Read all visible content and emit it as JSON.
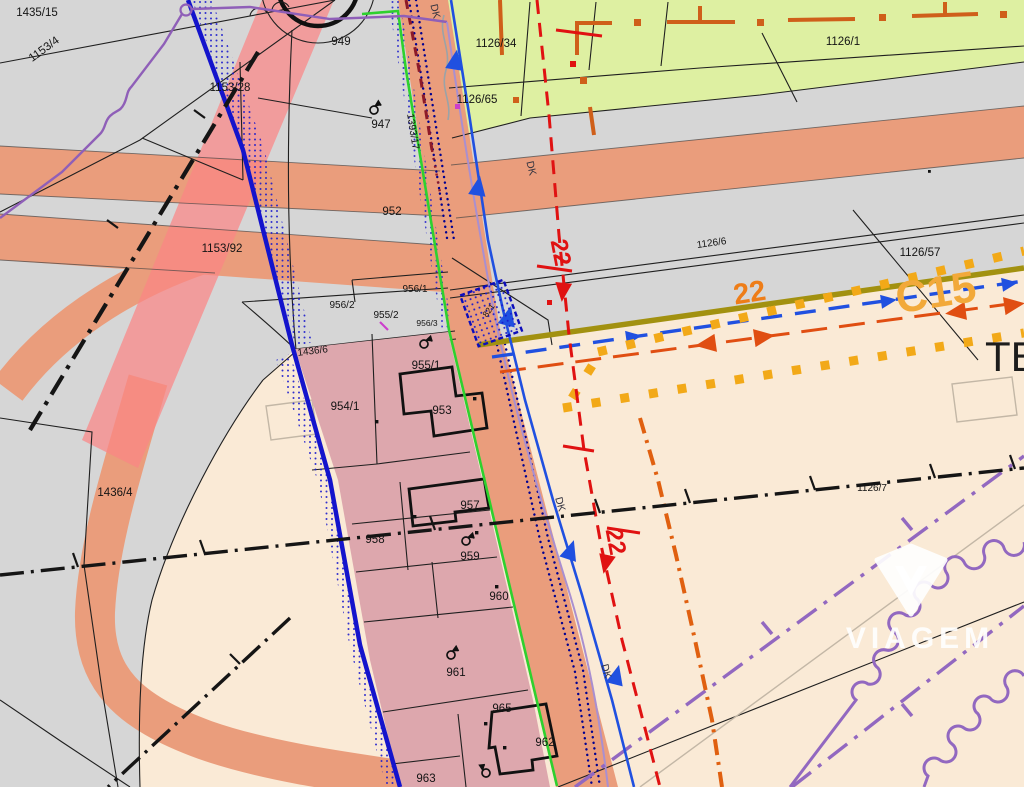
{
  "labels": {
    "p1435_15": "1435/15",
    "p1153_4": "1153/4",
    "p1153_28": "1153/28",
    "p949": "949",
    "p947": "947",
    "p1393_17": "1393/17",
    "p952": "952",
    "p1153_92": "1153/92",
    "p956_1": "956/1",
    "p956_2": "956/2",
    "p955_2": "955/2",
    "p956_3": "956/3",
    "p821": "821",
    "p1436_6": "1436/6",
    "p954_1": "954/1",
    "p955_1": "955/1",
    "p953": "953",
    "p1436_4": "1436/4",
    "p957": "957",
    "p958": "958",
    "p959": "959",
    "p960": "960",
    "p961": "961",
    "p965": "965",
    "p962": "962",
    "p963": "963",
    "p1126_34": "1126/34",
    "p1126_65": "1126/65",
    "p1126_1": "1126/1",
    "p1126_6": "1126/6",
    "p1126_57": "1126/57",
    "p1126_7": "1126/7"
  },
  "annotations": {
    "te": "TE",
    "c15": "C15",
    "orange_22": "22",
    "red_22_upper": "22",
    "red_22_lower": "22",
    "dk": "DK"
  },
  "watermark": {
    "brand": "VIAGEM"
  },
  "colors": {
    "base_gray": "#d6d6d6",
    "beige": "#faead6",
    "green_area": "#def0a2",
    "road": "#ea9d7c",
    "pink_band": "#fb8585",
    "zone_pink": "#dda7ad",
    "boundary_blue": "#1414cc",
    "green_line": "#2ed12e",
    "olive": "#a29110",
    "orange_marker": "#f2a918",
    "arrow_blue": "#2050e0",
    "red_line": "#e01212",
    "orange_red": "#e04e12",
    "purple": "#8f5fb8",
    "maroon": "#8e1a28"
  }
}
